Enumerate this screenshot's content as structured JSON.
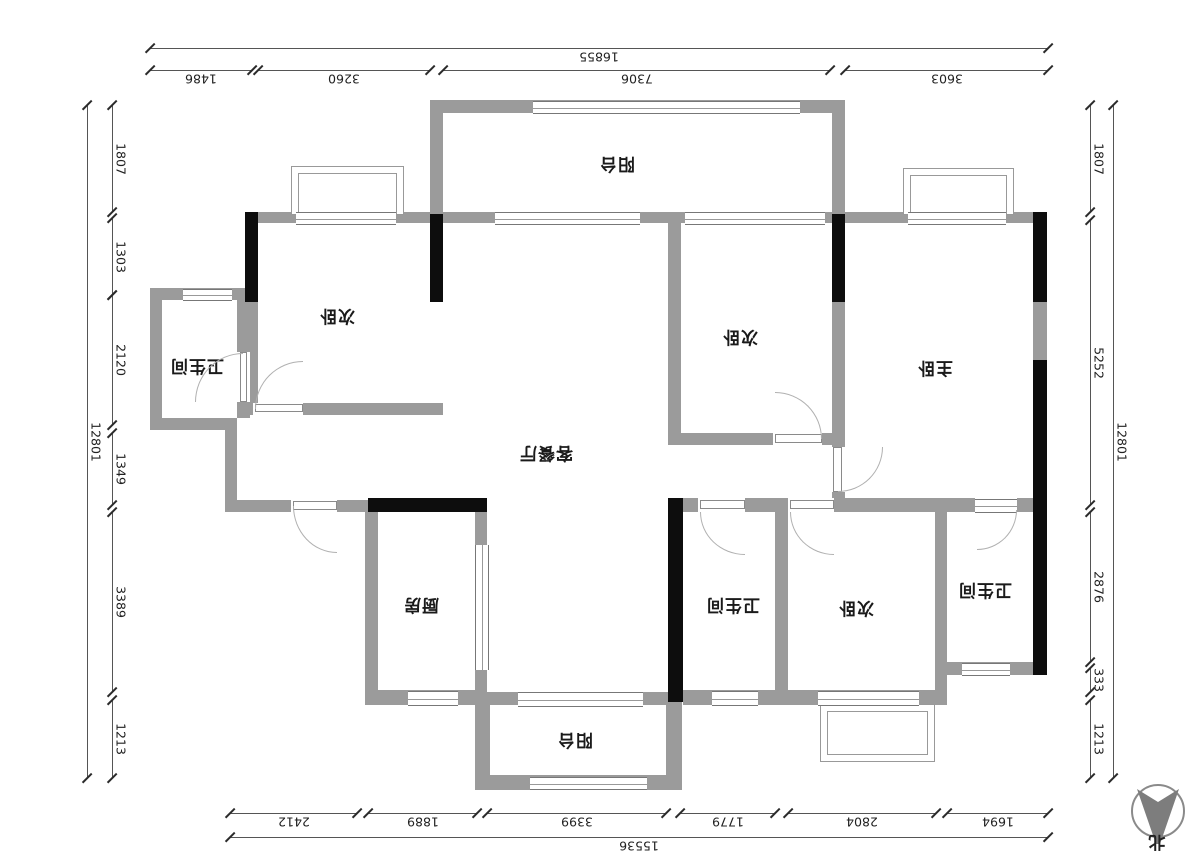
{
  "rooms": {
    "balcony_top": "阳台",
    "bedroom_top_left": "次卧",
    "bath_top_left": "卫生间",
    "bedroom_top_right": "次卧",
    "master_bedroom": "主卧",
    "living_dining": "客餐厅",
    "kitchen": "厨房",
    "bath_bottom": "卫生间",
    "bedroom_bottom": "次卧",
    "bath_right": "卫生间",
    "balcony_bottom": "阳台"
  },
  "dims": {
    "top": {
      "total": "16855",
      "segments": [
        "1486",
        "3260",
        "7306",
        "3603"
      ]
    },
    "bottom": {
      "total": "15536",
      "segments": [
        "2412",
        "1889",
        "3399",
        "1779",
        "2804",
        "1694"
      ]
    },
    "left": {
      "total": "12801",
      "segments": [
        "1807",
        "1303",
        "2120",
        "1349",
        "3389",
        "1213"
      ]
    },
    "right": {
      "total": "12801",
      "segments": [
        "1807",
        "5252",
        "2876",
        "333",
        "1213"
      ]
    }
  },
  "compass": {
    "label": "北"
  },
  "colors": {
    "wall": "#9b9b9b",
    "structure": "#0d0d0d",
    "dimension_text": "#222222",
    "dimension_line": "#555555"
  }
}
